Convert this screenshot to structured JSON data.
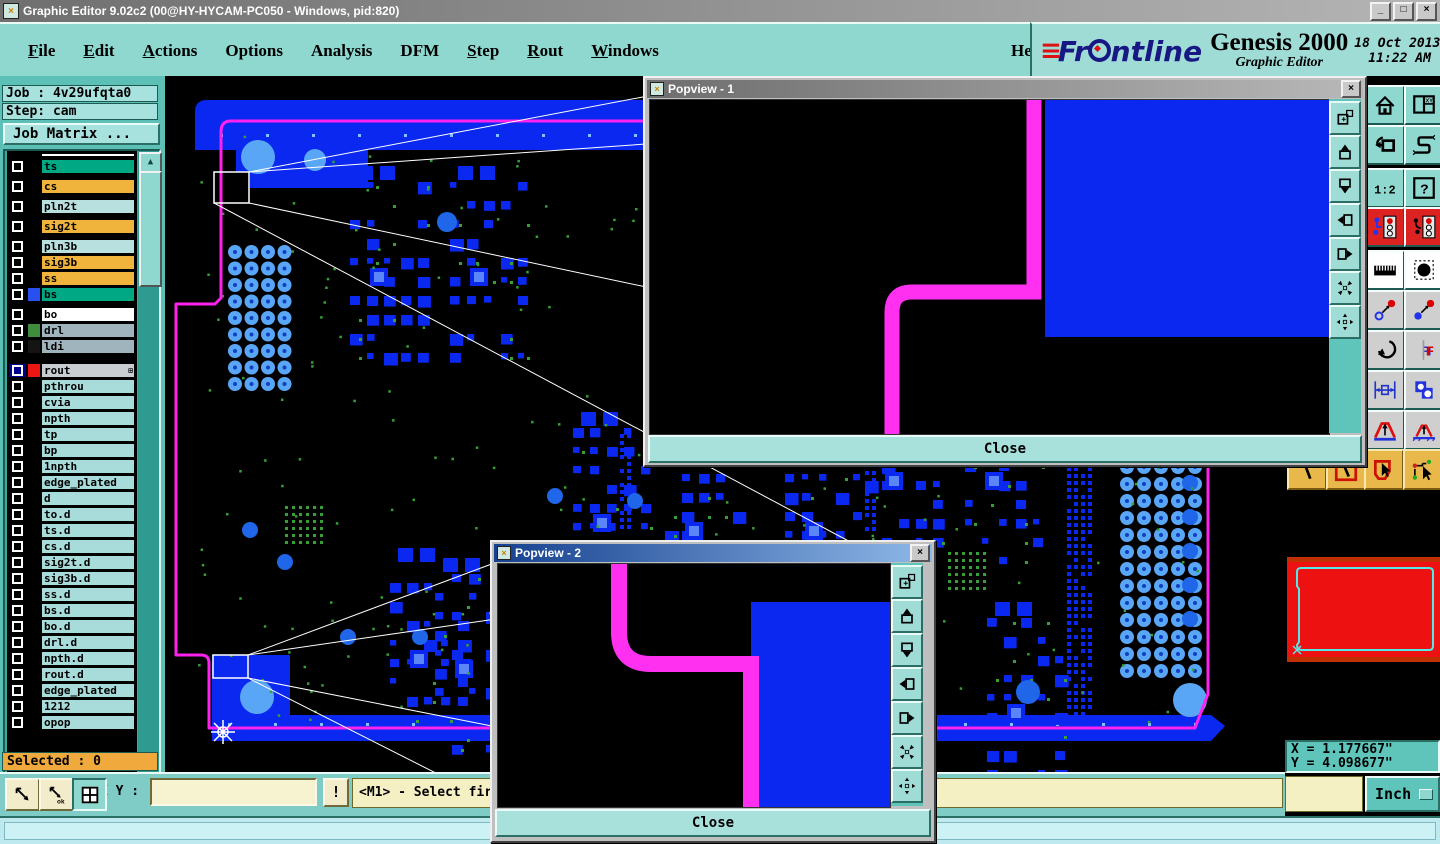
{
  "window": {
    "title": "Graphic Editor 9.02c2 (00@HY-HYCAM-PC050 - Windows, pid:820)",
    "minimize": "_",
    "maximize": "□",
    "close": "×",
    "icon_glyph": "×"
  },
  "menubar": {
    "items": [
      {
        "label": "File",
        "hotkey": true
      },
      {
        "label": "Edit",
        "hotkey": true
      },
      {
        "label": "Actions",
        "hotkey": true
      },
      {
        "label": "Options",
        "hotkey": false
      },
      {
        "label": "Analysis",
        "hotkey": false
      },
      {
        "label": "DFM",
        "hotkey": false
      },
      {
        "label": "Step",
        "hotkey": true
      },
      {
        "label": "Rout",
        "hotkey": true
      },
      {
        "label": "Windows",
        "hotkey": true
      }
    ],
    "help": "Help"
  },
  "brand": {
    "name": "Frontline",
    "product": "Genesis 2000",
    "subtitle": "Graphic Editor",
    "date": "18 Oct 2013",
    "time": "11:22 AM"
  },
  "sidebar": {
    "job_label": "Job : 4v29ufqta0",
    "step_label": "Step: cam",
    "matrix_button": "Job Matrix ...",
    "selected": "Selected : 0",
    "layers": [
      {
        "label": "",
        "bg": "#ffffff",
        "sliver": true
      },
      {
        "label": "ts",
        "bg": "#00a884"
      },
      {
        "label": "cs",
        "bg": "#f0b43c",
        "gap": 4
      },
      {
        "label": "pln2t",
        "bg": "#b8e0de",
        "gap": 4
      },
      {
        "label": "sig2t",
        "bg": "#f0b43c",
        "gap": 4
      },
      {
        "label": "pln3b",
        "bg": "#b8e0de",
        "gap": 4
      },
      {
        "label": "sig3b",
        "bg": "#f0b43c"
      },
      {
        "label": "ss",
        "bg": "#f0b43c"
      },
      {
        "label": "bs",
        "bg": "#00a884",
        "swatch": "#2850f0"
      },
      {
        "label": "bo",
        "bg": "#ffffff",
        "gap": 4
      },
      {
        "label": "drl",
        "bg": "#9fb4bc",
        "swatch": "#3f8c3f"
      },
      {
        "label": "ldi",
        "bg": "#9fb4bc",
        "swatch": "#141414"
      },
      {
        "label": "rout",
        "bg": "#c8cdd1",
        "swatch": "#ee1515",
        "cb": "#000090",
        "grid": true,
        "gap": 8
      },
      {
        "label": "pthrou",
        "bg": "#a8dcda"
      },
      {
        "label": "cvia",
        "bg": "#a8dcda"
      },
      {
        "label": "npth",
        "bg": "#a8dcda"
      },
      {
        "label": "tp",
        "bg": "#a8dcda"
      },
      {
        "label": "bp",
        "bg": "#a8dcda"
      },
      {
        "label": "1npth",
        "bg": "#a8dcda"
      },
      {
        "label": "edge_plated",
        "bg": "#a8dcda"
      },
      {
        "label": "d",
        "bg": "#a8dcda"
      },
      {
        "label": "to.d",
        "bg": "#a8dcda"
      },
      {
        "label": "ts.d",
        "bg": "#a8dcda"
      },
      {
        "label": "cs.d",
        "bg": "#a8dcda"
      },
      {
        "label": "sig2t.d",
        "bg": "#a8dcda"
      },
      {
        "label": "sig3b.d",
        "bg": "#a8dcda"
      },
      {
        "label": "ss.d",
        "bg": "#a8dcda"
      },
      {
        "label": "bs.d",
        "bg": "#a8dcda"
      },
      {
        "label": "bo.d",
        "bg": "#a8dcda"
      },
      {
        "label": "drl.d",
        "bg": "#a8dcda"
      },
      {
        "label": "npth.d",
        "bg": "#a8dcda"
      },
      {
        "label": "rout.d",
        "bg": "#a8dcda"
      },
      {
        "label": "edge_plated",
        "bg": "#a8dcda"
      },
      {
        "label": "1212",
        "bg": "#a8dcda"
      },
      {
        "label": "opop",
        "bg": "#a8dcda"
      }
    ]
  },
  "statusbar": {
    "xy_label": "X Y :",
    "xy_value": "",
    "alert": "!",
    "message": "<M1> - Select first",
    "units": "Inch"
  },
  "coords": {
    "x": "X = 1.177667\"",
    "y": "Y = 4.098677\""
  },
  "popviews": [
    {
      "title": "Popview - 1",
      "close_label": "Close"
    },
    {
      "title": "Popview - 2",
      "close_label": "Close"
    }
  ],
  "toolbars": {
    "right": [
      {
        "name": "home-button",
        "icon": "home",
        "bg": "#8fd8d0"
      },
      {
        "name": "window-xy-button",
        "icon": "winxy",
        "bg": "#8fd8d0"
      },
      {
        "name": "undo-view-button",
        "icon": "undo",
        "bg": "#8fd8d0"
      },
      {
        "name": "serpentine-button",
        "icon": "spath",
        "bg": "#8fd8d0"
      },
      {
        "name": "scale-1-2-button",
        "icon": "ratio12",
        "bg": "#8fd8d0"
      },
      {
        "name": "query-button",
        "icon": "help2",
        "bg": "#8fd8d0"
      },
      {
        "name": "layer-signal-button",
        "icon": "traffica",
        "bg": "#dd2222"
      },
      {
        "name": "layer-signal-alt-button",
        "icon": "trafficb",
        "bg": "#dd2222"
      },
      {
        "name": "measure-button",
        "icon": "ruler",
        "bg": "#ffffff"
      },
      {
        "name": "pad-select-button",
        "icon": "pad",
        "bg": "#ffffff"
      },
      {
        "name": "select-open-button",
        "icon": "selopen",
        "bg": "#cfcfcf"
      },
      {
        "name": "select-filled-button",
        "icon": "selfill",
        "bg": "#cfcfcf"
      },
      {
        "name": "rotate-button",
        "icon": "rotate",
        "bg": "#cfcfcf"
      },
      {
        "name": "mirror-button",
        "icon": "mirror",
        "bg": "#cfcfcf"
      },
      {
        "name": "dimension-button",
        "icon": "dim",
        "bg": "#cfcfcf"
      },
      {
        "name": "shapes-button",
        "icon": "shapes",
        "bg": "#cfcfcf"
      },
      {
        "name": "angle-arrow-button",
        "icon": "aup1",
        "bg": "#cfcfcf"
      },
      {
        "name": "angle-arrow-alt-button",
        "icon": "aup2",
        "bg": "#cfcfcf"
      }
    ],
    "yellow": [
      {
        "name": "draw-line-mode-button",
        "icon": "slash"
      },
      {
        "name": "box-select-mode-button",
        "icon": "boxslash"
      },
      {
        "name": "polygon-select-mode-button",
        "icon": "polycursor"
      },
      {
        "name": "net-select-mode-button",
        "icon": "netcursor"
      }
    ],
    "popup": [
      {
        "name": "popout-window-button",
        "icon": "winnew"
      },
      {
        "name": "pan-up-button",
        "icon": "panup"
      },
      {
        "name": "pan-down-button",
        "icon": "pandown"
      },
      {
        "name": "pan-left-button",
        "icon": "panleft"
      },
      {
        "name": "pan-right-button",
        "icon": "panright"
      },
      {
        "name": "zoom-fit-button",
        "icon": "zoomfit"
      },
      {
        "name": "zoom-center-button",
        "icon": "zoomctr"
      }
    ],
    "bottom_left": [
      {
        "name": "measure-diagonal-button",
        "icon": "diag",
        "pressed": false
      },
      {
        "name": "measure-ok-button",
        "icon": "diagok",
        "pressed": false
      },
      {
        "name": "quadrant-grid-button",
        "icon": "quad",
        "pressed": true
      }
    ]
  },
  "colors": {
    "pcb_blue": "#0a28f0",
    "light_blue": "#5aa6f6",
    "mid_blue": "#1f66e8",
    "outline_magenta": "#ff22ee",
    "trace_magenta": "#ff30f0",
    "speck_green": "#37a037",
    "overview_red": "#ee1111",
    "overview_red_border": "#c03000",
    "overview_cyan": "#55e8e8",
    "leader_white": "#ffffff"
  }
}
